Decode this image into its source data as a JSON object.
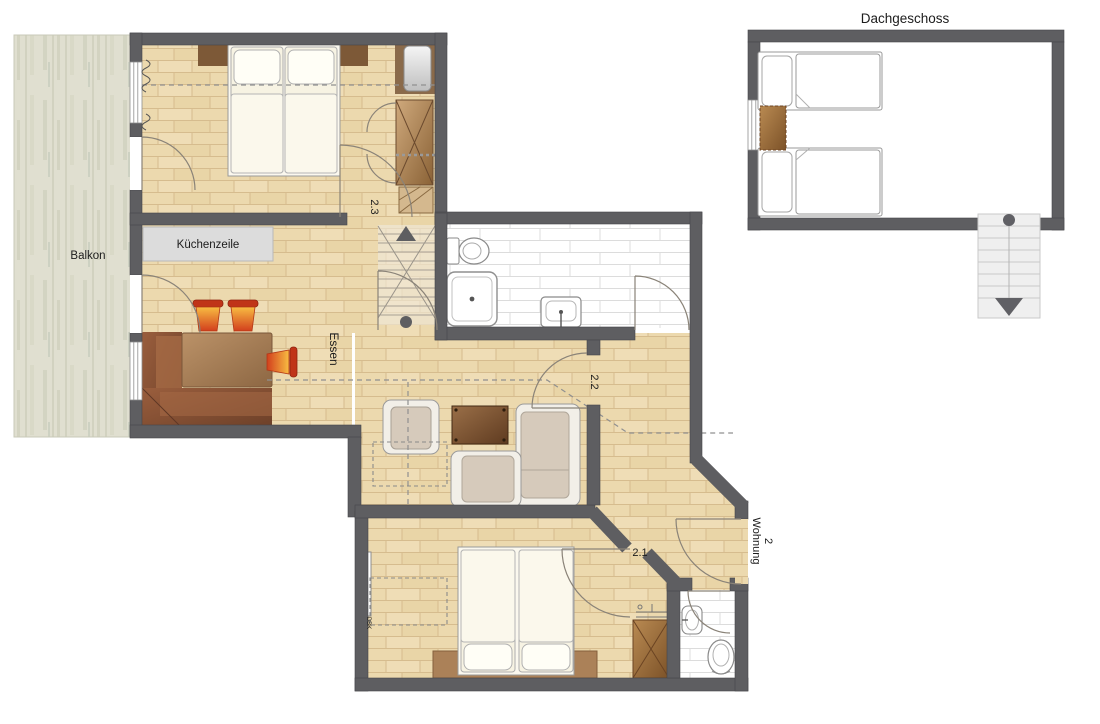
{
  "labels": {
    "attic": "Dachgeschoss",
    "balcony": "Balkon",
    "kitchenette": "Küchenzeile",
    "dining": "Essen",
    "room_2_3": "2.3",
    "room_2_2": "2.2",
    "room_2_1": "2.1",
    "apartment_line1": "Wohnung",
    "apartment_line2": "2",
    "radiator_tag": "DBK"
  },
  "colors": {
    "wall": "#5e5e61",
    "floor_base": "#ecd9ae",
    "floor_line": "#d6bc8e",
    "balcony_base": "#e0dfd0",
    "tile_grout": "#dcdcdc",
    "kitchen_unit": "#dcdcdc",
    "chair_orange_top": "#f8bc42",
    "chair_orange_bottom": "#d23f1d",
    "furniture_brown": "#8a6038"
  }
}
